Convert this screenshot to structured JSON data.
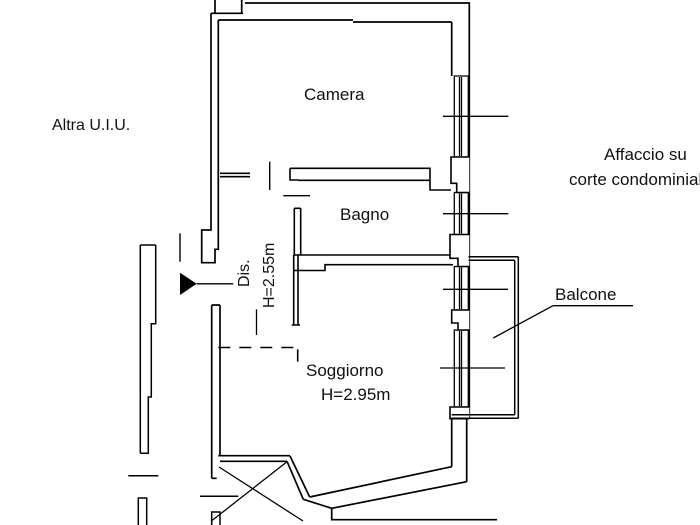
{
  "floorplan": {
    "labels": {
      "camera": "Camera",
      "bagno": "Bagno",
      "soggiorno": "Soggiorno",
      "soggiorno_height": "H=2.95m",
      "dis": "Dis.",
      "dis_height": "H=2.55m",
      "balcone": "Balcone",
      "altra_uiu": "Altra U.I.U.",
      "affaccio_line1": "Affaccio su",
      "affaccio_line2": "corte condominiale"
    },
    "colors": {
      "line": "#000000",
      "text": "#111111",
      "background": "#ffffff"
    }
  }
}
